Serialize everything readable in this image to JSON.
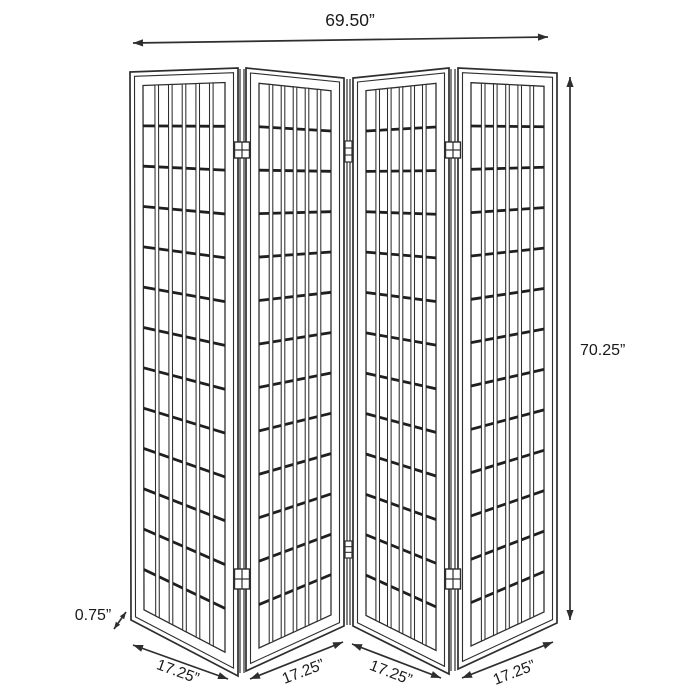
{
  "diagram": {
    "product": "4-panel folding room divider screen",
    "dimensions": {
      "total_width": "69.50”",
      "total_height": "70.25”",
      "panel_thickness": "0.75”",
      "panel_widths": [
        "17.25”",
        "17.25”",
        "17.25”",
        "17.25”"
      ]
    },
    "panels": {
      "count": 4,
      "grid_columns": 6,
      "grid_rows": 13,
      "hinge_junctions": 3
    },
    "colors": {
      "background": "#ffffff",
      "line": "#2e2e2e",
      "bar": "#1f1f1f",
      "text": "#1a1a1a"
    }
  }
}
